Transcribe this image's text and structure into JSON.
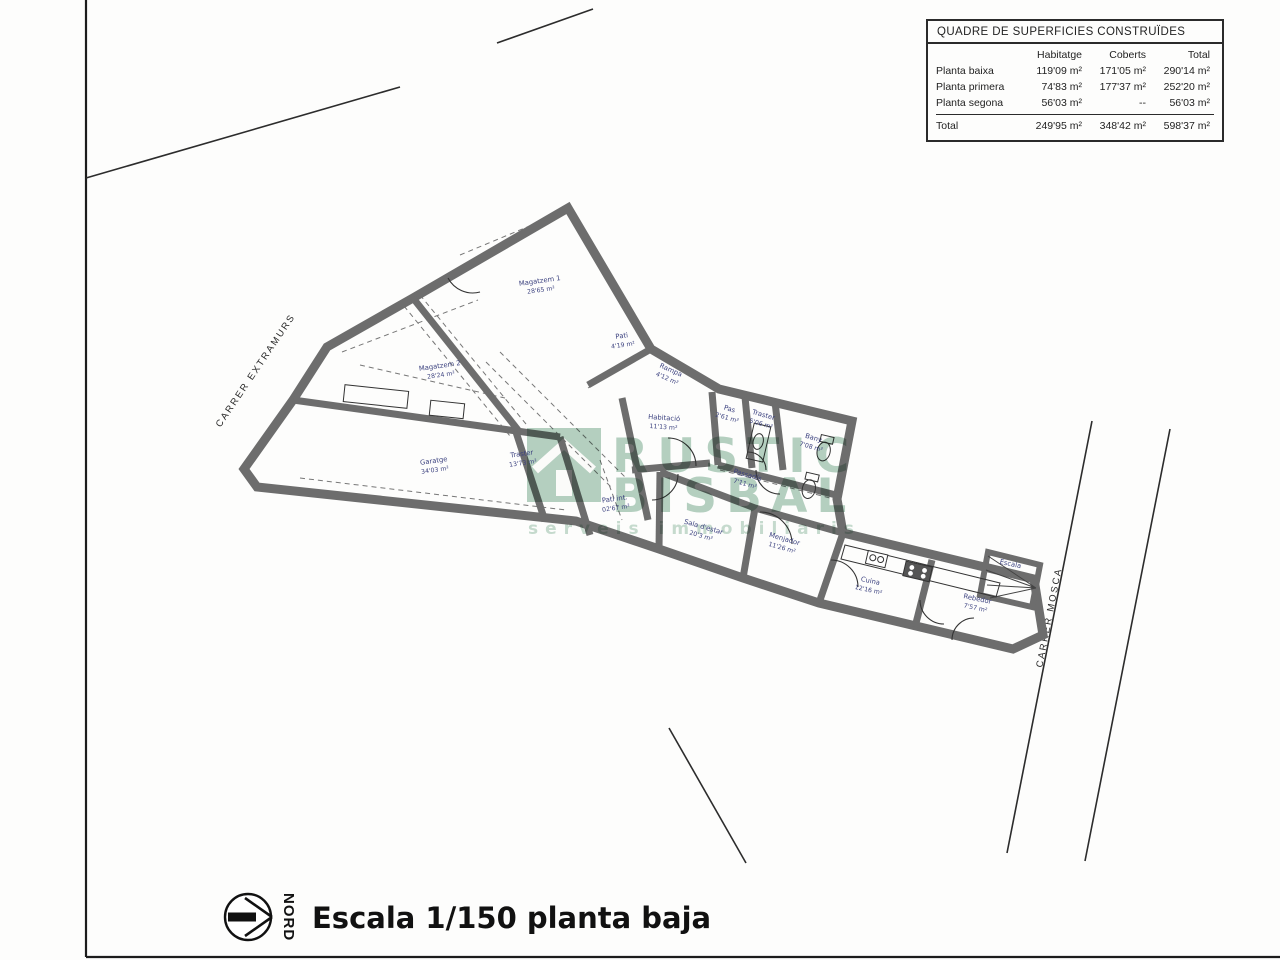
{
  "table": {
    "title": "QUADRE DE SUPERFICIES CONSTRUÏDES",
    "columns": [
      "Habitatge",
      "Coberts",
      "Total"
    ],
    "rows": [
      {
        "label": "Planta baixa",
        "habitatge": "119'09 m²",
        "coberts": "171'05 m²",
        "total": "290'14 m²"
      },
      {
        "label": "Planta primera",
        "habitatge": "74'83 m²",
        "coberts": "177'37 m²",
        "total": "252'20 m²"
      },
      {
        "label": "Planta segona",
        "habitatge": "56'03 m²",
        "coberts": "--",
        "total": "56'03 m²"
      }
    ],
    "total_row": {
      "label": "Total",
      "habitatge": "249'95 m²",
      "coberts": "348'42 m²",
      "total": "598'37 m²"
    }
  },
  "streets": {
    "left": "CARRER EXTRAMURS",
    "right": "CARRER MOSCA"
  },
  "watermark": {
    "line1": "RUSTIC",
    "line2": "BISBAL",
    "tagline": "serveis immobiliaris",
    "color": "#a9c9b8"
  },
  "footer": {
    "north_label": "NORD",
    "scale_text": "Escala 1/150 planta baja"
  },
  "rooms": [
    {
      "name": "Magatzem 1",
      "area": "28'65 m²"
    },
    {
      "name": "Pati",
      "area": "4'19 m²"
    },
    {
      "name": "Magatzem 2",
      "area": "28'24 m²"
    },
    {
      "name": "Rampa",
      "area": "4'12 m²"
    },
    {
      "name": "Habitació",
      "area": "11'13 m²"
    },
    {
      "name": "Pas",
      "area": "2'61 m²"
    },
    {
      "name": "Traster",
      "area": "5'06 m²"
    },
    {
      "name": "Bany",
      "area": "7'08 m²"
    },
    {
      "name": "Traster",
      "area": "13'73 m²"
    },
    {
      "name": "Garatge",
      "area": "34'03 m²"
    },
    {
      "name": "Passadís",
      "area": "7'11 m²"
    },
    {
      "name": "Pati int.",
      "area": "02'67 m²"
    },
    {
      "name": "Sala d'estar",
      "area": "20'3 m²"
    },
    {
      "name": "Menjador",
      "area": "11'26 m²"
    },
    {
      "name": "Cuina",
      "area": "12'16 m²"
    },
    {
      "name": "Rebedor",
      "area": "7'57 m²"
    },
    {
      "name": "Escala",
      "area": ""
    }
  ]
}
